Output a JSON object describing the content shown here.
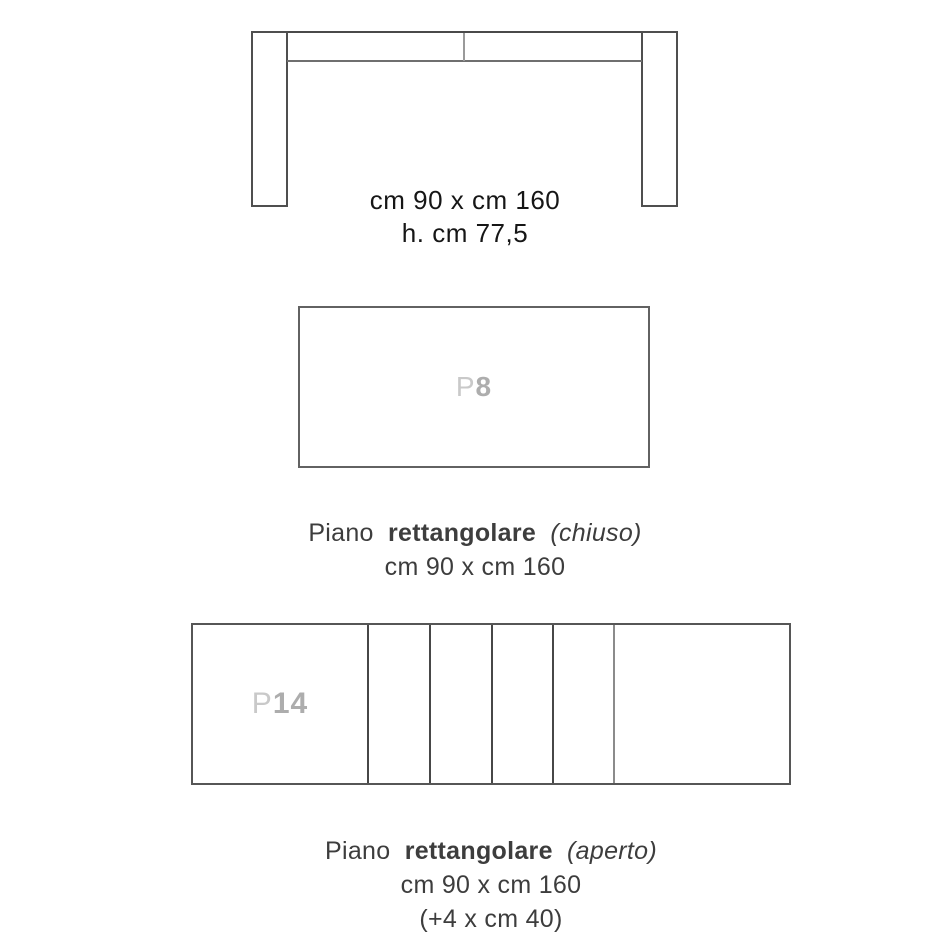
{
  "colors": {
    "background": "#ffffff",
    "drawing_line_dark": "#4a4a4a",
    "drawing_line_mid": "#6f6f6f",
    "drawing_line_light": "#9a9a9a",
    "dimension_text": "#161616",
    "caption_text": "#3d3d3d",
    "panel_label_prefix": "#c9c9c9",
    "panel_label_number": "#adadad"
  },
  "front_view": {
    "dim_line1": "cm 90 x cm 160",
    "dim_line2": "h. cm 77,5"
  },
  "closed_view": {
    "label_prefix": "P",
    "label_number": "8",
    "caption_regular": "Piano",
    "caption_bold": "rettangolare",
    "caption_italic": "(chiuso)",
    "caption_dims": "cm 90 x cm 160"
  },
  "open_view": {
    "label_prefix": "P",
    "label_number": "14",
    "caption_regular": "Piano",
    "caption_bold": "rettangolare",
    "caption_italic": "(aperto)",
    "caption_dims": "cm 90 x cm 160",
    "caption_extra": "(+4 x cm 40)"
  }
}
